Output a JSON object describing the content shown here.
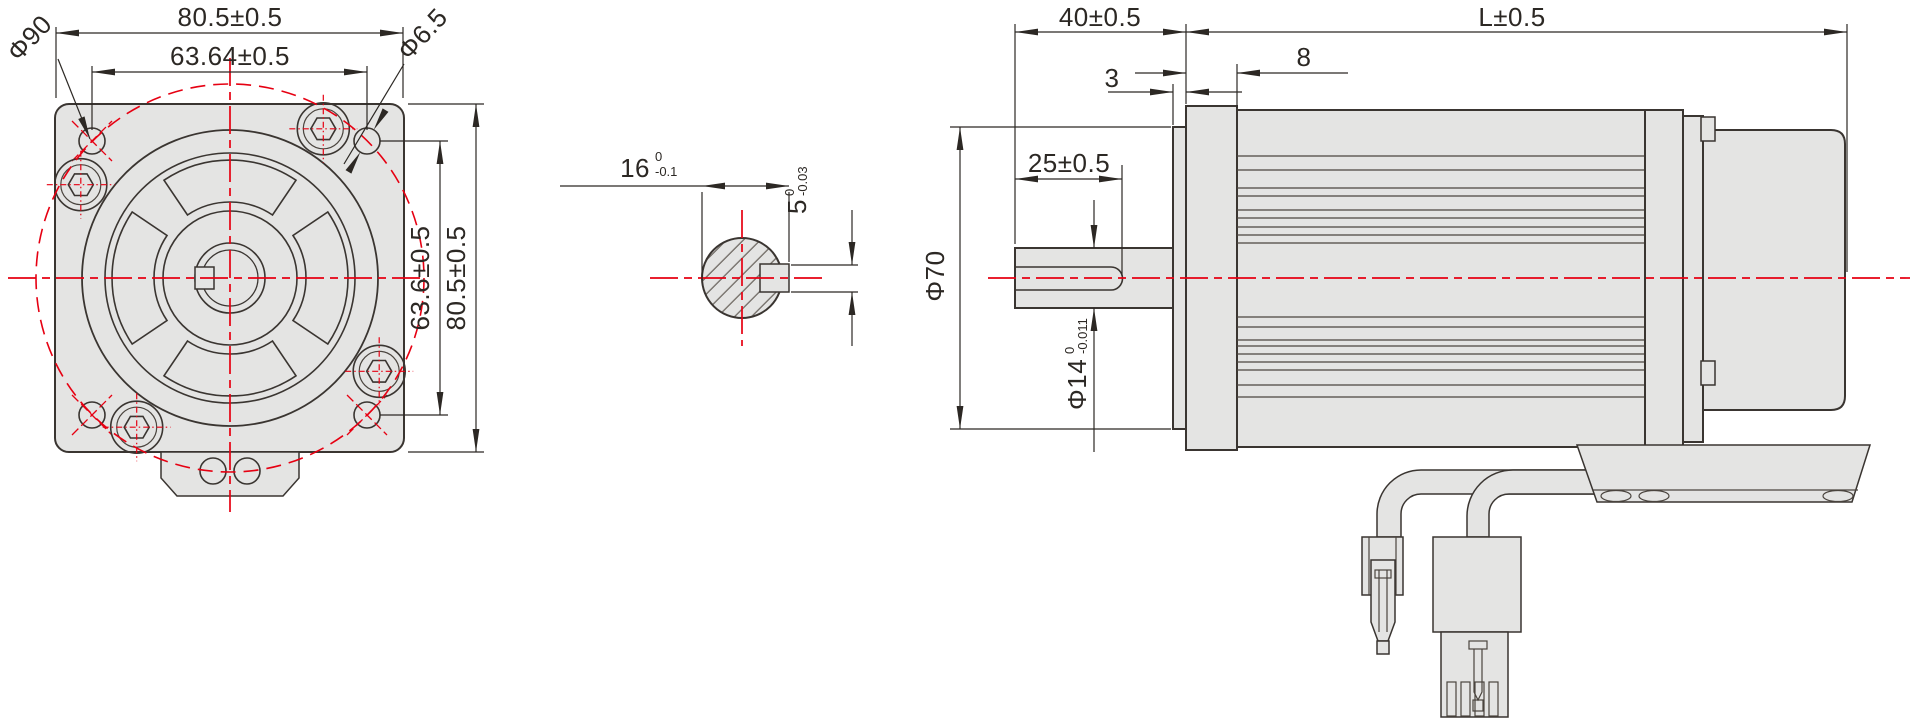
{
  "drawing_type": "servo-motor-dimensional-drawing",
  "views": {
    "front": {
      "dims": {
        "width": "80.5±0.5",
        "hole_pitch_h": "63.64±0.5",
        "bolt_circle": "Φ90",
        "hole_dia": "Φ6.5",
        "hole_pitch_v": "63.6±0.5",
        "height": "80.5±0.5"
      }
    },
    "section": {
      "dims": {
        "across": "16",
        "across_tol_hi": "0",
        "across_tol_lo": "-0.1",
        "key_w": "5",
        "key_tol_hi": "0",
        "key_tol_lo": "-0.03"
      }
    },
    "side": {
      "dims": {
        "shaft_len": "40±0.5",
        "body_len": "L±0.5",
        "boss_h": "3",
        "flange_t": "8",
        "key_len": "25±0.5",
        "boss_dia": "Φ70",
        "shaft_dia": "Φ14",
        "shaft_tol_hi": "0",
        "shaft_tol_lo": "-0.011"
      }
    }
  },
  "colors": {
    "part_fill": "#e4e4e3",
    "outline": "#3a3531",
    "dimension_line": "#2c2824",
    "centerline_red": "#e60012",
    "hatch": "#6b655f"
  }
}
